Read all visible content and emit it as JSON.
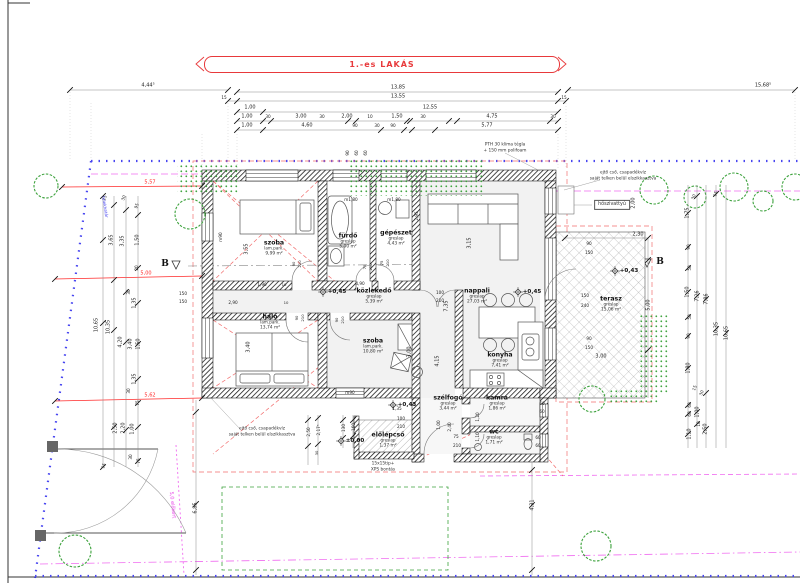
{
  "title": {
    "text": "1.-es LAKÁS"
  },
  "colors": {
    "red": "#e8393b",
    "dim_red": "#ff2a2a",
    "blue": "#4846f0",
    "magenta": "#e743e7",
    "green": "#3da23d",
    "ink": "#222"
  },
  "rooms": [
    {
      "name": "szoba",
      "finish": "lam.park.",
      "area": "9,99 m²",
      "x": 274,
      "y": 248
    },
    {
      "name": "fürdő",
      "finish": "greslap",
      "area": "5,90 m²",
      "x": 348,
      "y": 241
    },
    {
      "name": "gépészet",
      "finish": "greslap",
      "area": "4,43 m²",
      "x": 396,
      "y": 238
    },
    {
      "name": "nappali",
      "finish": "greslap",
      "area": "27,03 m²",
      "x": 477,
      "y": 296
    },
    {
      "name": "közlekedő",
      "finish": "greslap",
      "area": "5,39 m²",
      "x": 374,
      "y": 296
    },
    {
      "name": "háló",
      "finish": "lam.park.",
      "area": "13,74 m²",
      "x": 270,
      "y": 322
    },
    {
      "name": "szoba",
      "finish": "lam.park.",
      "area": "10,80 m²",
      "x": 373,
      "y": 346
    },
    {
      "name": "konyha",
      "finish": "greslap",
      "area": "7,41 m²",
      "x": 500,
      "y": 360
    },
    {
      "name": "terasz",
      "finish": "greslap",
      "area": "15,06 m²",
      "x": 611,
      "y": 304
    },
    {
      "name": "szélfogó",
      "finish": "greslap",
      "area": "3,44 m²",
      "x": 448,
      "y": 403
    },
    {
      "name": "kamra",
      "finish": "greslap",
      "area": "1,86 m²",
      "x": 497,
      "y": 403
    },
    {
      "name": "wc",
      "finish": "greslap",
      "area": "1,71 m²",
      "x": 494,
      "y": 437
    },
    {
      "name": "előlépcső",
      "finish": "greslap",
      "area": "1,37 m²",
      "x": 388,
      "y": 440
    }
  ],
  "levels": [
    {
      "t": "+0,45",
      "x": 337,
      "y": 292
    },
    {
      "t": "+0,45",
      "x": 532,
      "y": 292
    },
    {
      "t": "+0,43",
      "x": 629,
      "y": 271
    },
    {
      "t": "+0,43",
      "x": 407,
      "y": 405
    },
    {
      "t": "±0,00",
      "x": 355,
      "y": 441
    }
  ],
  "section_markers": [
    {
      "t": "B",
      "x": 165,
      "y": 264
    },
    {
      "t": "B",
      "x": 660,
      "y": 262
    }
  ],
  "notes": [
    {
      "lines": [
        "PTH 30 klíma tégla",
        "+ 150 mm polifoam"
      ],
      "x": 505,
      "y": 148
    },
    {
      "lines": [
        "ejtő cső, csapadékvíz",
        "saját telken belül elszikkasztva"
      ],
      "x": 623,
      "y": 176
    },
    {
      "lines": [
        "ejtő cső, csapadékvíz",
        "saját telken belül elszikkasztva"
      ],
      "x": 262,
      "y": 432
    },
    {
      "lines": [
        "hőszivattyú"
      ],
      "x": 612,
      "y": 205,
      "boxed": true
    },
    {
      "lines": [
        "15x15tip+",
        "XPS bontás"
      ],
      "x": 383,
      "y": 467
    },
    {
      "lines": [
        "5,0 előkert"
      ],
      "x": 172,
      "y": 505,
      "c": "magenta",
      "r": 84,
      "s": 5
    },
    {
      "lines": [
        "telekhatár"
      ],
      "x": 105,
      "y": 207,
      "c": "blue",
      "r": 81,
      "s": 4.2
    }
  ],
  "dims": [
    {
      "t": "4,44⁵",
      "x": 148,
      "y": 86
    },
    {
      "t": "13,85",
      "x": 398,
      "y": 88
    },
    {
      "t": "15,68⁵",
      "x": 763,
      "y": 86
    },
    {
      "t": "15",
      "x": 224,
      "y": 98,
      "s": 4.2
    },
    {
      "t": "13,55",
      "x": 398,
      "y": 97
    },
    {
      "t": "15",
      "x": 564,
      "y": 98,
      "s": 4.2
    },
    {
      "t": "1,00",
      "x": 250,
      "y": 108
    },
    {
      "t": "12,55",
      "x": 430,
      "y": 108
    },
    {
      "t": "1,00",
      "x": 247,
      "y": 117
    },
    {
      "t": "30",
      "x": 268,
      "y": 117,
      "s": 4.2
    },
    {
      "t": "3,00",
      "x": 301,
      "y": 117
    },
    {
      "t": "30",
      "x": 322,
      "y": 117,
      "s": 4.2
    },
    {
      "t": "2,00",
      "x": 347,
      "y": 117
    },
    {
      "t": "10",
      "x": 370,
      "y": 117,
      "s": 4.2
    },
    {
      "t": "1,50",
      "x": 397,
      "y": 117
    },
    {
      "t": "30",
      "x": 423,
      "y": 117,
      "s": 4.2
    },
    {
      "t": "4,75",
      "x": 492,
      "y": 117
    },
    {
      "t": "30",
      "x": 553,
      "y": 117,
      "s": 4.2
    },
    {
      "t": "1,00",
      "x": 247,
      "y": 126
    },
    {
      "t": "4,60",
      "x": 307,
      "y": 126
    },
    {
      "t": "90",
      "x": 355,
      "y": 126,
      "s": 4.2
    },
    {
      "t": "30",
      "x": 377,
      "y": 126,
      "s": 4.2
    },
    {
      "t": "90",
      "x": 393,
      "y": 126,
      "s": 4.2
    },
    {
      "t": "5,77",
      "x": 487,
      "y": 126
    },
    {
      "t": "15",
      "x": 105,
      "y": 198,
      "r": -70,
      "s": 4.2
    },
    {
      "t": "30",
      "x": 124,
      "y": 198,
      "r": -70,
      "s": 4.2
    },
    {
      "t": "95",
      "x": 137,
      "y": 206,
      "r": -70,
      "s": 4.2
    },
    {
      "t": "3,65",
      "x": 112,
      "y": 240,
      "r": -90
    },
    {
      "t": "3,35",
      "x": 123,
      "y": 241,
      "r": -90
    },
    {
      "t": "1,50",
      "x": 138,
      "y": 240,
      "r": -90
    },
    {
      "t": "20",
      "x": 137,
      "y": 268,
      "r": -90,
      "s": 4.2
    },
    {
      "t": "30",
      "x": 129,
      "y": 292,
      "r": -90,
      "s": 4.2
    },
    {
      "t": "1,35",
      "x": 135,
      "y": 303,
      "r": -90
    },
    {
      "t": "10,65",
      "x": 97,
      "y": 325,
      "r": -90
    },
    {
      "t": "10,35",
      "x": 109,
      "y": 327,
      "r": -90
    },
    {
      "t": "4,20",
      "x": 121,
      "y": 342,
      "r": -90
    },
    {
      "t": "3,40",
      "x": 131,
      "y": 344,
      "r": -90
    },
    {
      "t": "1,50",
      "x": 139,
      "y": 344,
      "r": -90
    },
    {
      "t": "1,35",
      "x": 135,
      "y": 379,
      "r": -90
    },
    {
      "t": "30",
      "x": 129,
      "y": 391,
      "r": -90,
      "s": 4.2
    },
    {
      "t": "75",
      "x": 138,
      "y": 403,
      "r": -90,
      "s": 4.2
    },
    {
      "t": "2,50",
      "x": 116,
      "y": 428,
      "r": -90
    },
    {
      "t": "2,20",
      "x": 124,
      "y": 428,
      "r": -90
    },
    {
      "t": "1,00",
      "x": 133,
      "y": 429,
      "r": -90
    },
    {
      "t": "30",
      "x": 131,
      "y": 457,
      "r": -90,
      "s": 4.2
    },
    {
      "t": "75",
      "x": 139,
      "y": 461,
      "r": -90,
      "s": 4.2
    },
    {
      "t": "15",
      "x": 104,
      "y": 466,
      "r": -70,
      "s": 4.2
    },
    {
      "t": "30",
      "x": 694,
      "y": 197,
      "r": -70,
      "s": 4.2
    },
    {
      "t": "15",
      "x": 716,
      "y": 194,
      "r": -70,
      "s": 4.2
    },
    {
      "t": "1,75",
      "x": 688,
      "y": 213,
      "r": -90
    },
    {
      "t": "90",
      "x": 689,
      "y": 247,
      "r": -90,
      "s": 4.2
    },
    {
      "t": "50",
      "x": 690,
      "y": 268,
      "r": -90,
      "s": 4.2
    },
    {
      "t": "1,50",
      "x": 688,
      "y": 292,
      "r": -90
    },
    {
      "t": "7,26",
      "x": 698,
      "y": 296,
      "r": -90
    },
    {
      "t": "7,86",
      "x": 707,
      "y": 299,
      "r": -90
    },
    {
      "t": "50",
      "x": 690,
      "y": 317,
      "r": -90,
      "s": 4.2
    },
    {
      "t": "90",
      "x": 689,
      "y": 336,
      "r": -90,
      "s": 4.2
    },
    {
      "t": "10,35",
      "x": 717,
      "y": 329,
      "r": -90
    },
    {
      "t": "10,65",
      "x": 727,
      "y": 333,
      "r": -90
    },
    {
      "t": "1,80",
      "x": 689,
      "y": 368,
      "r": -90
    },
    {
      "t": "15",
      "x": 695,
      "y": 388,
      "r": -70,
      "s": 4.2
    },
    {
      "t": "30",
      "x": 702,
      "y": 393,
      "r": -70,
      "s": 4.2
    },
    {
      "t": "60",
      "x": 690,
      "y": 405,
      "r": -90,
      "s": 4.2
    },
    {
      "t": "60",
      "x": 690,
      "y": 414,
      "r": -90,
      "s": 4.2
    },
    {
      "t": "1,00",
      "x": 698,
      "y": 412,
      "r": -90
    },
    {
      "t": "10",
      "x": 699,
      "y": 424,
      "r": -90,
      "s": 4.2
    },
    {
      "t": "1,10",
      "x": 690,
      "y": 434,
      "r": -90
    },
    {
      "t": "2,50",
      "x": 706,
      "y": 429,
      "r": -90
    },
    {
      "t": "90",
      "x": 348,
      "y": 153,
      "r": -90,
      "s": 4.2
    },
    {
      "t": "60",
      "x": 357,
      "y": 153,
      "r": -90,
      "s": 4.2
    },
    {
      "t": "60",
      "x": 366,
      "y": 153,
      "r": -90,
      "s": 4.2
    },
    {
      "t": "2,00",
      "x": 634,
      "y": 203,
      "r": -90
    },
    {
      "t": "2,30",
      "x": 638,
      "y": 235
    },
    {
      "t": "90",
      "x": 589,
      "y": 244,
      "s": 4.2
    },
    {
      "t": "150",
      "x": 589,
      "y": 253,
      "s": 4.2
    },
    {
      "t": "150",
      "x": 585,
      "y": 296,
      "s": 4.2
    },
    {
      "t": "240",
      "x": 585,
      "y": 306,
      "s": 4.2
    },
    {
      "t": "90",
      "x": 589,
      "y": 339,
      "s": 4.2
    },
    {
      "t": "150",
      "x": 589,
      "y": 348,
      "s": 4.2
    },
    {
      "t": "3,00",
      "x": 601,
      "y": 357
    },
    {
      "t": "5,00",
      "x": 649,
      "y": 305,
      "r": -90
    },
    {
      "t": "5,57",
      "x": 150,
      "y": 183,
      "c": "dim_red"
    },
    {
      "t": "5,00",
      "x": 146,
      "y": 274,
      "c": "dim_red"
    },
    {
      "t": "5,62",
      "x": 150,
      "y": 396,
      "c": "dim_red"
    },
    {
      "t": "m90",
      "x": 221,
      "y": 237,
      "r": -90,
      "s": 4.2
    },
    {
      "t": "3,55",
      "x": 247,
      "y": 249,
      "r": -90
    },
    {
      "t": "m1,80",
      "x": 351,
      "y": 200,
      "s": 4.2
    },
    {
      "t": "m1,80",
      "x": 394,
      "y": 200,
      "s": 4.2
    },
    {
      "t": "2,95",
      "x": 417,
      "y": 216,
      "r": -90,
      "s": 4.2
    },
    {
      "t": "3,15",
      "x": 470,
      "y": 243,
      "r": -90
    },
    {
      "t": "150",
      "x": 183,
      "y": 294,
      "s": 4.2
    },
    {
      "t": "150",
      "x": 183,
      "y": 302,
      "s": 4.2
    },
    {
      "t": "1,90",
      "x": 262,
      "y": 285,
      "s": 4.2
    },
    {
      "t": "10",
      "x": 284,
      "y": 285,
      "s": 3.8
    },
    {
      "t": "4,90",
      "x": 360,
      "y": 284,
      "s": 4.2
    },
    {
      "t": "2,90",
      "x": 233,
      "y": 303,
      "s": 4.2
    },
    {
      "t": "10",
      "x": 286,
      "y": 303,
      "s": 3.8
    },
    {
      "t": "90",
      "x": 294,
      "y": 264,
      "r": -90,
      "s": 3.8
    },
    {
      "t": "210",
      "x": 300,
      "y": 264,
      "r": -90,
      "s": 3.8
    },
    {
      "t": "75",
      "x": 365,
      "y": 267,
      "r": -90,
      "s": 3.8
    },
    {
      "t": "210",
      "x": 371,
      "y": 267,
      "r": -90,
      "s": 3.8
    },
    {
      "t": "75",
      "x": 382,
      "y": 263,
      "r": -90,
      "s": 3.8
    },
    {
      "t": "210",
      "x": 388,
      "y": 263,
      "r": -90,
      "s": 3.8
    },
    {
      "t": "90",
      "x": 297,
      "y": 318,
      "r": -90,
      "s": 3.8
    },
    {
      "t": "210",
      "x": 303,
      "y": 318,
      "r": -90,
      "s": 3.8
    },
    {
      "t": "90",
      "x": 337,
      "y": 320,
      "r": -90,
      "s": 3.8
    },
    {
      "t": "210",
      "x": 343,
      "y": 320,
      "r": -90,
      "s": 3.8
    },
    {
      "t": "100",
      "x": 440,
      "y": 293,
      "s": 4.2
    },
    {
      "t": "210",
      "x": 440,
      "y": 301,
      "s": 4.2
    },
    {
      "t": "7,35",
      "x": 447,
      "y": 306,
      "r": -90
    },
    {
      "t": "4,15",
      "x": 438,
      "y": 361,
      "r": -90
    },
    {
      "t": "3,40",
      "x": 249,
      "y": 347,
      "r": -90
    },
    {
      "t": "3,00",
      "x": 410,
      "y": 352,
      "r": -90
    },
    {
      "t": "m90",
      "x": 350,
      "y": 393,
      "s": 4.2
    },
    {
      "t": "1,00",
      "x": 439,
      "y": 425,
      "r": -90,
      "s": 4.2
    },
    {
      "t": "2,40",
      "x": 450,
      "y": 427,
      "r": -90,
      "s": 4.2
    },
    {
      "t": "1,20",
      "x": 478,
      "y": 417,
      "r": -90,
      "s": 4.2
    },
    {
      "t": "1,10",
      "x": 478,
      "y": 437,
      "r": -90,
      "s": 4.2
    },
    {
      "t": "1,35",
      "x": 397,
      "y": 409,
      "s": 4.2
    },
    {
      "t": "100",
      "x": 401,
      "y": 419,
      "s": 4.2
    },
    {
      "t": "210",
      "x": 401,
      "y": 427,
      "s": 4.2
    },
    {
      "t": "75",
      "x": 456,
      "y": 437,
      "s": 4.2
    },
    {
      "t": "210",
      "x": 457,
      "y": 446,
      "s": 4.2
    },
    {
      "t": "60",
      "x": 542,
      "y": 404,
      "s": 4.2
    },
    {
      "t": "60",
      "x": 542,
      "y": 412,
      "s": 4.2
    },
    {
      "t": "60",
      "x": 538,
      "y": 438,
      "s": 4.2
    },
    {
      "t": "60",
      "x": 538,
      "y": 446,
      "s": 4.2
    },
    {
      "t": "2,50",
      "x": 309,
      "y": 432,
      "r": -90,
      "s": 4.2
    },
    {
      "t": "2,17⁵",
      "x": 319,
      "y": 430,
      "r": -90,
      "s": 4.2
    },
    {
      "t": "30",
      "x": 317,
      "y": 453,
      "r": -90,
      "s": 3.8
    },
    {
      "t": "130",
      "x": 344,
      "y": 428,
      "r": -90,
      "s": 4.2
    },
    {
      "t": "160",
      "x": 354,
      "y": 427,
      "r": -90,
      "s": 4.2
    },
    {
      "t": "6,85",
      "x": 196,
      "y": 508,
      "r": -90
    },
    {
      "t": "4,31",
      "x": 533,
      "y": 505,
      "r": -90
    }
  ]
}
